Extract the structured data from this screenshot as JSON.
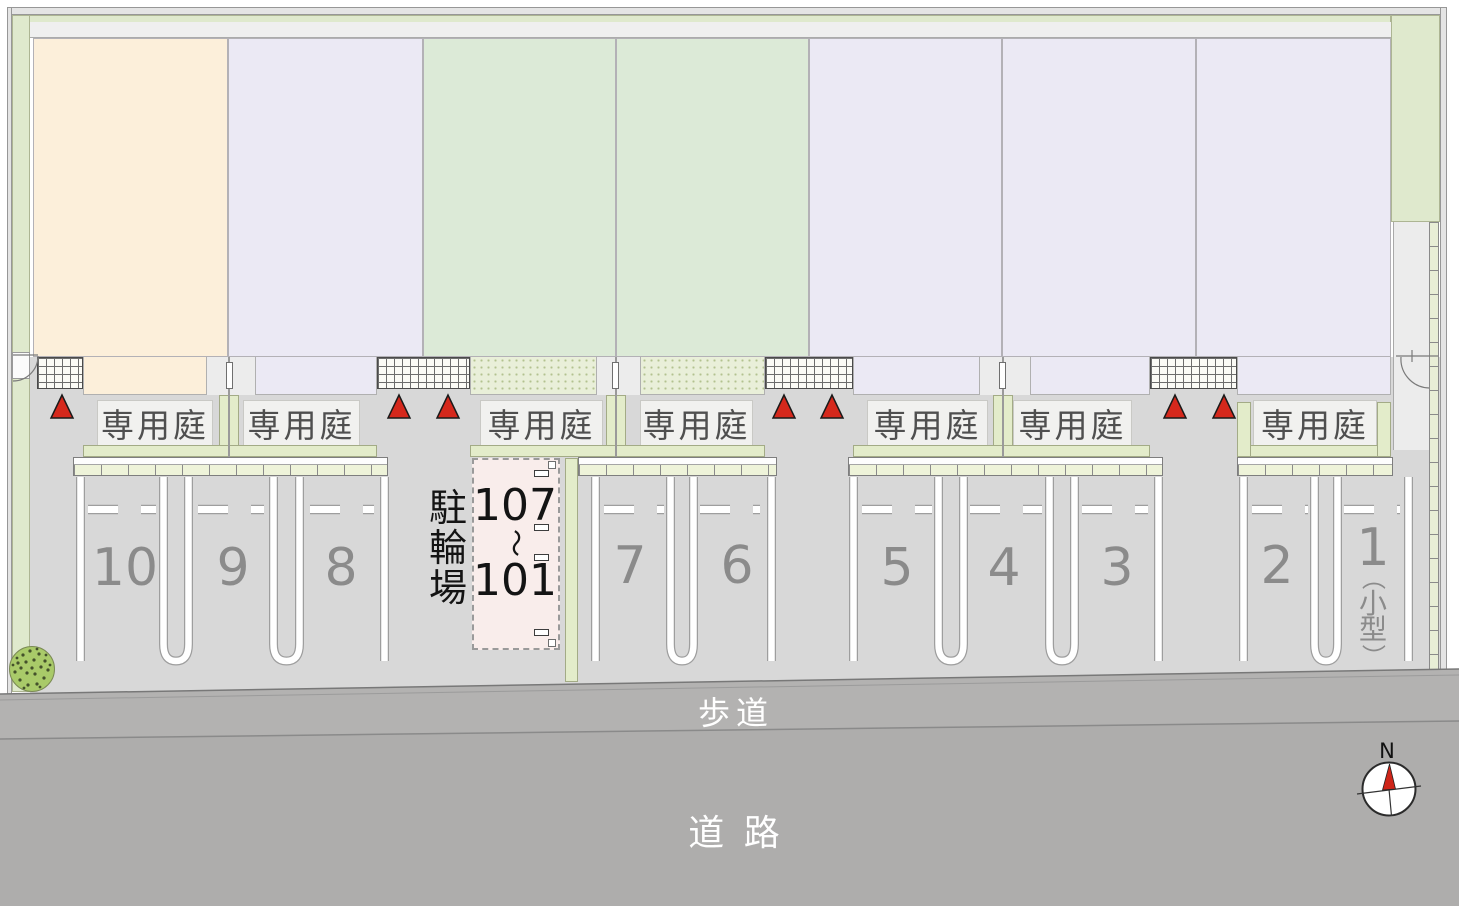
{
  "plan": {
    "garden_label": "専用庭",
    "parking_numbers": [
      "10",
      "9",
      "8",
      "7",
      "6",
      "5",
      "4",
      "3",
      "2",
      "1"
    ],
    "space1_note_chars": [
      "（",
      "小",
      "型",
      "）"
    ],
    "bicycle_label_chars": [
      "駐",
      "輪",
      "場"
    ],
    "bicycle_range": {
      "from": "107",
      "tilde": "〜",
      "to": "101"
    },
    "sidewalk_label": "歩道",
    "road_label": "道 路",
    "compass_north": "N",
    "colors": {
      "building_cream": "#fcefda",
      "building_lavender": "#ebe9f4",
      "building_green": "#dcead7",
      "hedge_green": "#dfe9cd",
      "garden_strip_green": "#e3ecca",
      "parking_gray": "#d8d8d8",
      "sidewalk_gray": "#b3b2b1",
      "road_gray": "#aeadac",
      "marker_red": "#d5281c",
      "bicycle_area_pink": "#f9edeb"
    }
  }
}
